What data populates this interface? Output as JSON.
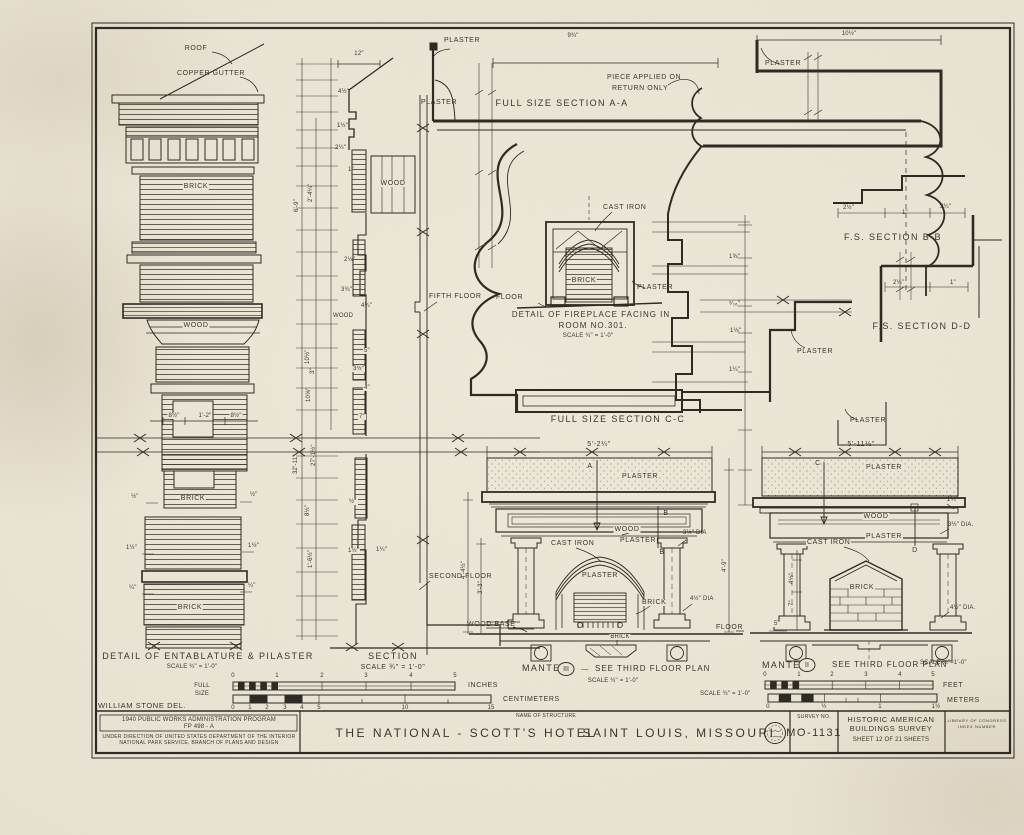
{
  "pilaster": {
    "roof": "ROOF",
    "copper_gutter": "COPPER GUTTER",
    "brick_top": "BRICK",
    "wood": "WOOD",
    "brick_mid": "BRICK",
    "brick_low": "BRICK",
    "dim_left": "8½\"",
    "dim_center": "1'-2\"",
    "dim_right": "8½\"",
    "dim_half_l": "½\"",
    "dim_half_r": "½\"",
    "dim_1half_l": "1½\"",
    "dim_1half_r": "1½\"",
    "dim_q_l": "¼\"",
    "dim_q_r": "¼\"",
    "caption": "DETAIL OF ENTABLATURE & PILASTER",
    "scale": "SCALE ¾\" = 1'-0\""
  },
  "section": {
    "dim_top": "12\"",
    "plaster": "PLASTER",
    "wood": "WOOD",
    "wood2": "WOOD",
    "fifth_floor": "FIFTH FLOOR",
    "second_floor": "SECOND FLOOR",
    "dim_6_9": "6'-9\"",
    "dim_2_4": "2'-4¼\"",
    "dim_32_11": "32'-11\"",
    "dim_27_1": "27'-1½\"",
    "dim_8h": "8½\"",
    "dim_1_6": "1'-6½\"",
    "dim_10h": "10½\"",
    "dim_10e": "10⅝\"",
    "d1": "4½\"",
    "d2": "1½\"",
    "d3": "2¼\"",
    "d4": "1\"",
    "d5": "2⅛\"",
    "d6": "3¾\"",
    "d7": "4¼\"",
    "d8": "5\"",
    "d9": "3½\"",
    "d10": "4\"",
    "d11": "7\"",
    "d12": "½\"",
    "d13": "1½\"",
    "d14": "1¼\"",
    "d15": "3\"",
    "caption": "SECTION",
    "scale": "SCALE ¾\" = 1'-0\""
  },
  "section_aa": {
    "plaster": "PLASTER",
    "dim_width": "9¾\"",
    "note1": "PIECE APPLIED ON",
    "note2": "RETURN ONLY",
    "caption": "FULL SIZE SECTION A-A"
  },
  "section_cc": {
    "caption": "FULL SIZE SECTION C-C",
    "plaster_upper": "PLASTER",
    "plaster_lower": "PLASTER",
    "d1": "1⅝\"",
    "d2": "⁵⁄₁₆\"",
    "d3": "1⅛\"",
    "d4": "1¼\""
  },
  "section_bb": {
    "dim_top": "10½\"",
    "plaster": "PLASTER",
    "caption": "F.S. SECTION B-B",
    "d1": "2½\"",
    "d2": "1\"",
    "d3": "2¼\""
  },
  "section_dd": {
    "caption": "F.S. SECTION D-D",
    "d1": "2¼\"",
    "d2": "1\""
  },
  "fireplace": {
    "cast_iron": "CAST IRON",
    "brick": "BRICK",
    "plaster": "PLASTER",
    "floor": "FLOOR",
    "caption1": "DETAIL OF FIREPLACE FACING IN",
    "caption2": "ROOM NO.301.",
    "scale": "SCALE ¾\" = 1'-0\""
  },
  "mantel3": {
    "dim_width": "5'-2¼\"",
    "plaster_top": "PLASTER",
    "wood": "WOOD",
    "plaster_wall": "PLASTER",
    "cast_iron": "CAST IRON",
    "plaster_inner": "PLASTER",
    "brick": "BRICK",
    "brick_plan": "BRICK",
    "wood_base": "WOOD BASE",
    "floor": "FLOOR",
    "dia_top": "3½\" DIA",
    "dia_bottom": "4½\" DIA",
    "dim_left1": "4'-4½\"",
    "dim_left2": "3'-3\"",
    "dim_right": "4'-9\"",
    "marker_a": "A",
    "marker_b1": "B",
    "marker_b2": "B",
    "caption": "MANTEL",
    "numeral": "III",
    "dash": "—",
    "caption2": "SEE THIRD FLOOR PLAN",
    "scale": "SCALE ¾\" = 1'-0\""
  },
  "mantel2": {
    "dim_width": "5'-11½\"",
    "plaster_top": "PLASTER",
    "wood": "WOOD",
    "plaster_wall": "PLASTER",
    "cast_iron": "CAST IRON",
    "brick": "BRICK",
    "dia_top": "3½\" DIA.",
    "dia_bottom": "4½\" DIA.",
    "dim_quarter": "1¼\"",
    "dim_5": "5\"",
    "dim_41": "4⅛\"",
    "dim_7": "7\"",
    "marker_c": "C",
    "marker_d": "D",
    "caption": "MANTEL",
    "numeral": "II",
    "caption2": "SEE THIRD FLOOR PLAN",
    "scale": "SCALE ¾\"=1'-0\""
  },
  "scale_bars": {
    "full1": "FULL",
    "full2": "SIZE",
    "inches": "INCHES",
    "centimeters": "CENTIMETERS",
    "feet": "FEET",
    "meters": "METERS",
    "scale_note": "SCALE ¾\" = 1'-0\"",
    "in_ticks": [
      "0",
      "1",
      "2",
      "3",
      "4",
      "5"
    ],
    "cm_ticks": [
      "0",
      "1",
      "2",
      "3",
      "4",
      "5",
      "10",
      "15"
    ],
    "ft_ticks": [
      "0",
      "1",
      "2",
      "3",
      "4",
      "5"
    ],
    "m_ticks": [
      "0",
      "½",
      "1",
      "1½"
    ]
  },
  "title_block": {
    "delineator": "WILLIAM STONE DEL.",
    "program1": "1940 PUBLIC WORKS ADMINISTRATION PROGRAM",
    "program2": "FP 498 - A",
    "direction1": "UNDER DIRECTION OF UNITED STATES DEPARTMENT OF THE INTERIOR",
    "direction2": "NATIONAL PARK SERVICE, BRANCH OF PLANS AND DESIGN",
    "name_label": "NAME OF STRUCTURE",
    "name": "THE NATIONAL - SCOTT'S HOTEL",
    "city": "SAINT LOUIS, MISSOURI",
    "survey_label": "SURVEY NO.",
    "survey_no": "MO-1131",
    "org1": "HISTORIC AMERICAN",
    "org2": "BUILDINGS SURVEY",
    "sheet_info": "SHEET 12 OF 21 SHEETS",
    "loc1": "LIBRARY OF CONGRESS",
    "loc2": "INDEX NUMBER"
  }
}
